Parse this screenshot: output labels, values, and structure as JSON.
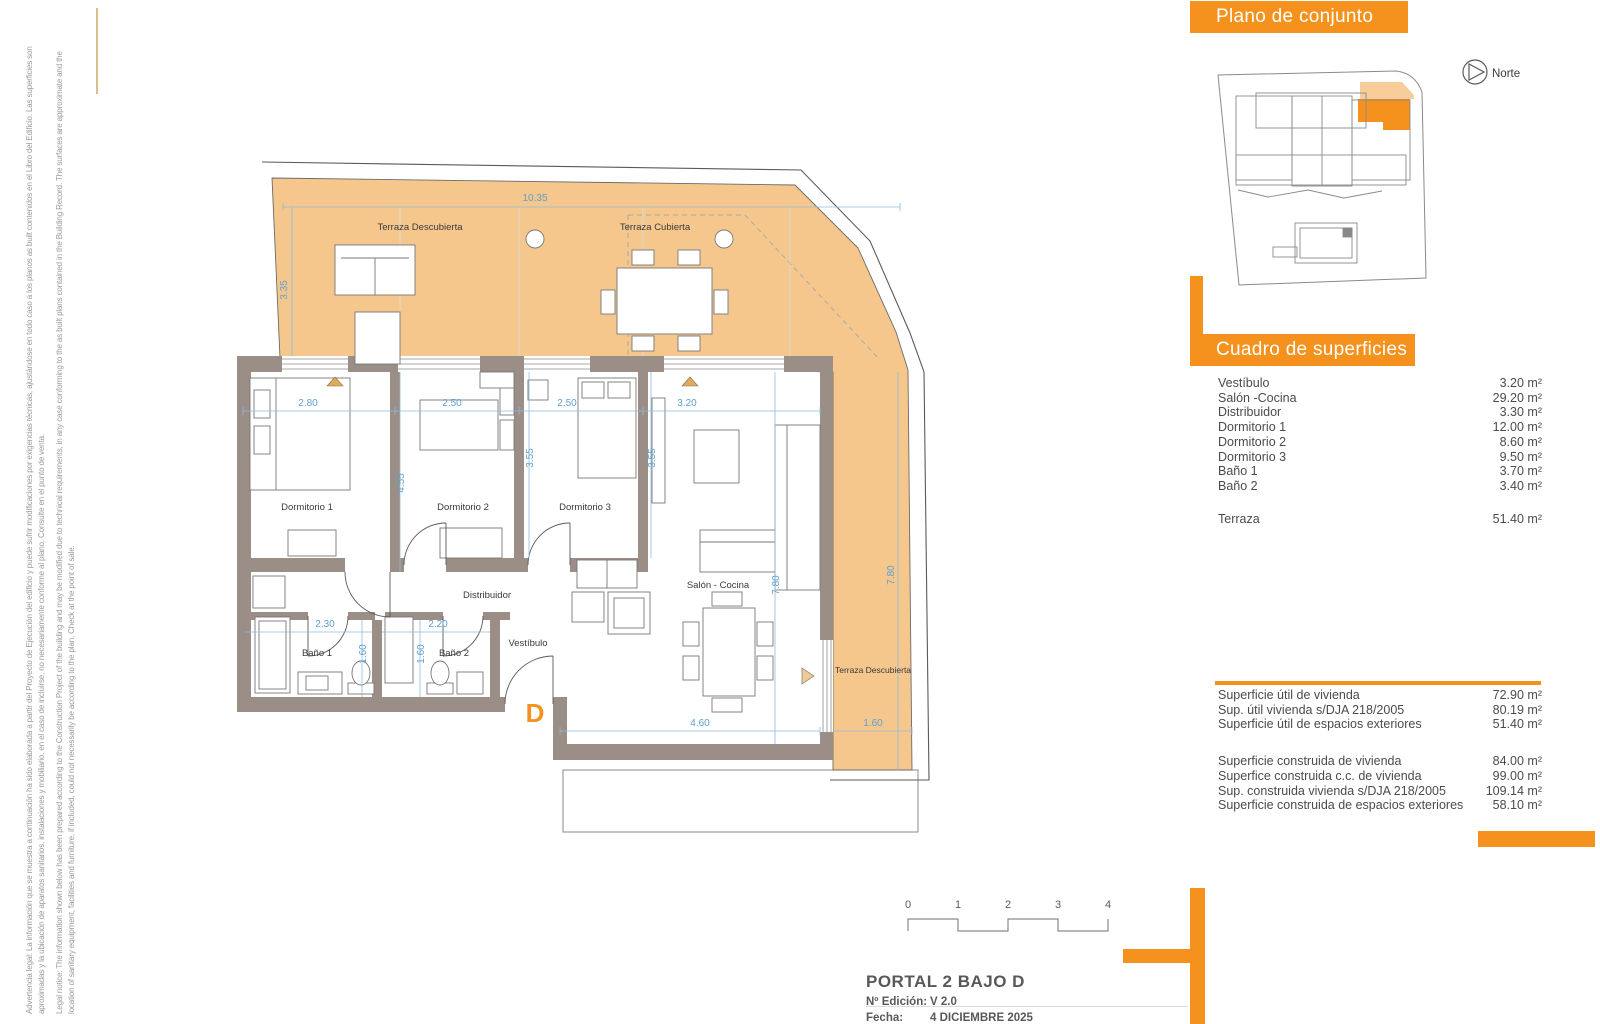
{
  "legal": {
    "es_line1": "Advertencia legal: La información que se muestra a continuación ha sido elaborada a partir del Proyecto de Ejecución del edificio y puede sufrir modificaciones por exigencias técnicas, ajustándose en todo caso a los planos as built contenidos en el Libro del Edificio. Las superficies son",
    "es_line2": "aproximadas y la ubicación de aparatos sanitarios, instalaciones y mobiliario, en el caso de incluirse, no necesariamente conforme al plano. Consulte en el punto de venta.",
    "en_line1": "Legal notice: The information shown below has been prepared according to the Construction Project of the building and may be modified due to technical requirements, in any case conforming to the as built plans contained in the Building Record. The surfaces are approximate and the",
    "en_line2": "location of sanitary equipment, facilities and furniture, if included, could not necessarily be according to the plan. Check at the point of sale."
  },
  "site_panel": {
    "title": "Plano de conjunto",
    "north_label": "Norte"
  },
  "areas_panel": {
    "title": "Cuadro de superficies",
    "rows": [
      {
        "label": "Vestíbulo",
        "value": "3.20 m²"
      },
      {
        "label": "Salón -Cocina",
        "value": "29.20 m²"
      },
      {
        "label": "Distribuidor",
        "value": "3.30 m²"
      },
      {
        "label": "Dormitorio 1",
        "value": "12.00 m²"
      },
      {
        "label": "Dormitorio 2",
        "value": "8.60 m²"
      },
      {
        "label": "Dormitorio 3",
        "value": "9.50 m²"
      },
      {
        "label": "Baño 1",
        "value": "3.70 m²"
      },
      {
        "label": "Baño 2",
        "value": "3.40 m²"
      }
    ],
    "terraza": {
      "label": "Terraza",
      "value": "51.40 m²"
    },
    "summary_util": [
      {
        "label": "Superficie útil de vivienda",
        "value": "72.90 m²"
      },
      {
        "label": "Sup. útil vivienda s/DJA 218/2005",
        "value": "80.19 m²"
      },
      {
        "label": "Superficie útil de espacios exteriores",
        "value": "51.40 m²"
      }
    ],
    "summary_built": [
      {
        "label": "Superficie construida de vivienda",
        "value": "84.00 m²"
      },
      {
        "label": "Superfice construida c.c. de vivienda",
        "value": "99.00 m²"
      },
      {
        "label": "Sup. construida vivienda s/DJA 218/2005",
        "value": "109.14 m²"
      },
      {
        "label": "Superficie construida de espacios exteriores",
        "value": "58.10 m²"
      }
    ]
  },
  "plan": {
    "unit_letter": "D",
    "labels": {
      "terraza_descubierta_top": "Terraza Descubierta",
      "terraza_cubierta": "Terraza Cubierta",
      "terraza_descubierta_right": "Terraza Descubierta",
      "dormitorio_1": "Dormitorio 1",
      "dormitorio_2": "Dormitorio 2",
      "dormitorio_3": "Dormitorio 3",
      "salon_cocina": "Salón - Cocina",
      "distribuidor": "Distribuidor",
      "vestibulo": "Vestíbulo",
      "bano_1": "Baño 1",
      "bano_2": "Baño 2"
    },
    "dims": {
      "top_width": "10.35",
      "top_left_height": "3.35",
      "d1_width": "2.80",
      "d2_width": "2.50",
      "d3_width": "2.50",
      "salon_width": "3.20",
      "d1_height": "4.55",
      "d2_height": "3.55",
      "d3_height": "3.55",
      "salon_height": "7.80",
      "terrace_right_height": "7.80",
      "bano1_width": "2.30",
      "bano2_width": "2.20",
      "bano1_height": "1.60",
      "bano2_height": "1.60",
      "salon_bottom_width": "4.60",
      "terrace_bottom_width": "1.60"
    }
  },
  "scale_bar": {
    "ticks": [
      "0",
      "1",
      "2",
      "3",
      "4"
    ]
  },
  "title_block": {
    "title": "PORTAL 2  BAJO D",
    "edition_label": "Nº Edición:",
    "edition_value": "V 2.0",
    "date_label": "Fecha:",
    "date_value": "4 DICIEMBRE 2025"
  },
  "colors": {
    "accent_orange": "#F5921E",
    "terrace_fill": "#F5C78C",
    "wall": "#9A8E86",
    "dim_blue": "#5FA0D0"
  }
}
